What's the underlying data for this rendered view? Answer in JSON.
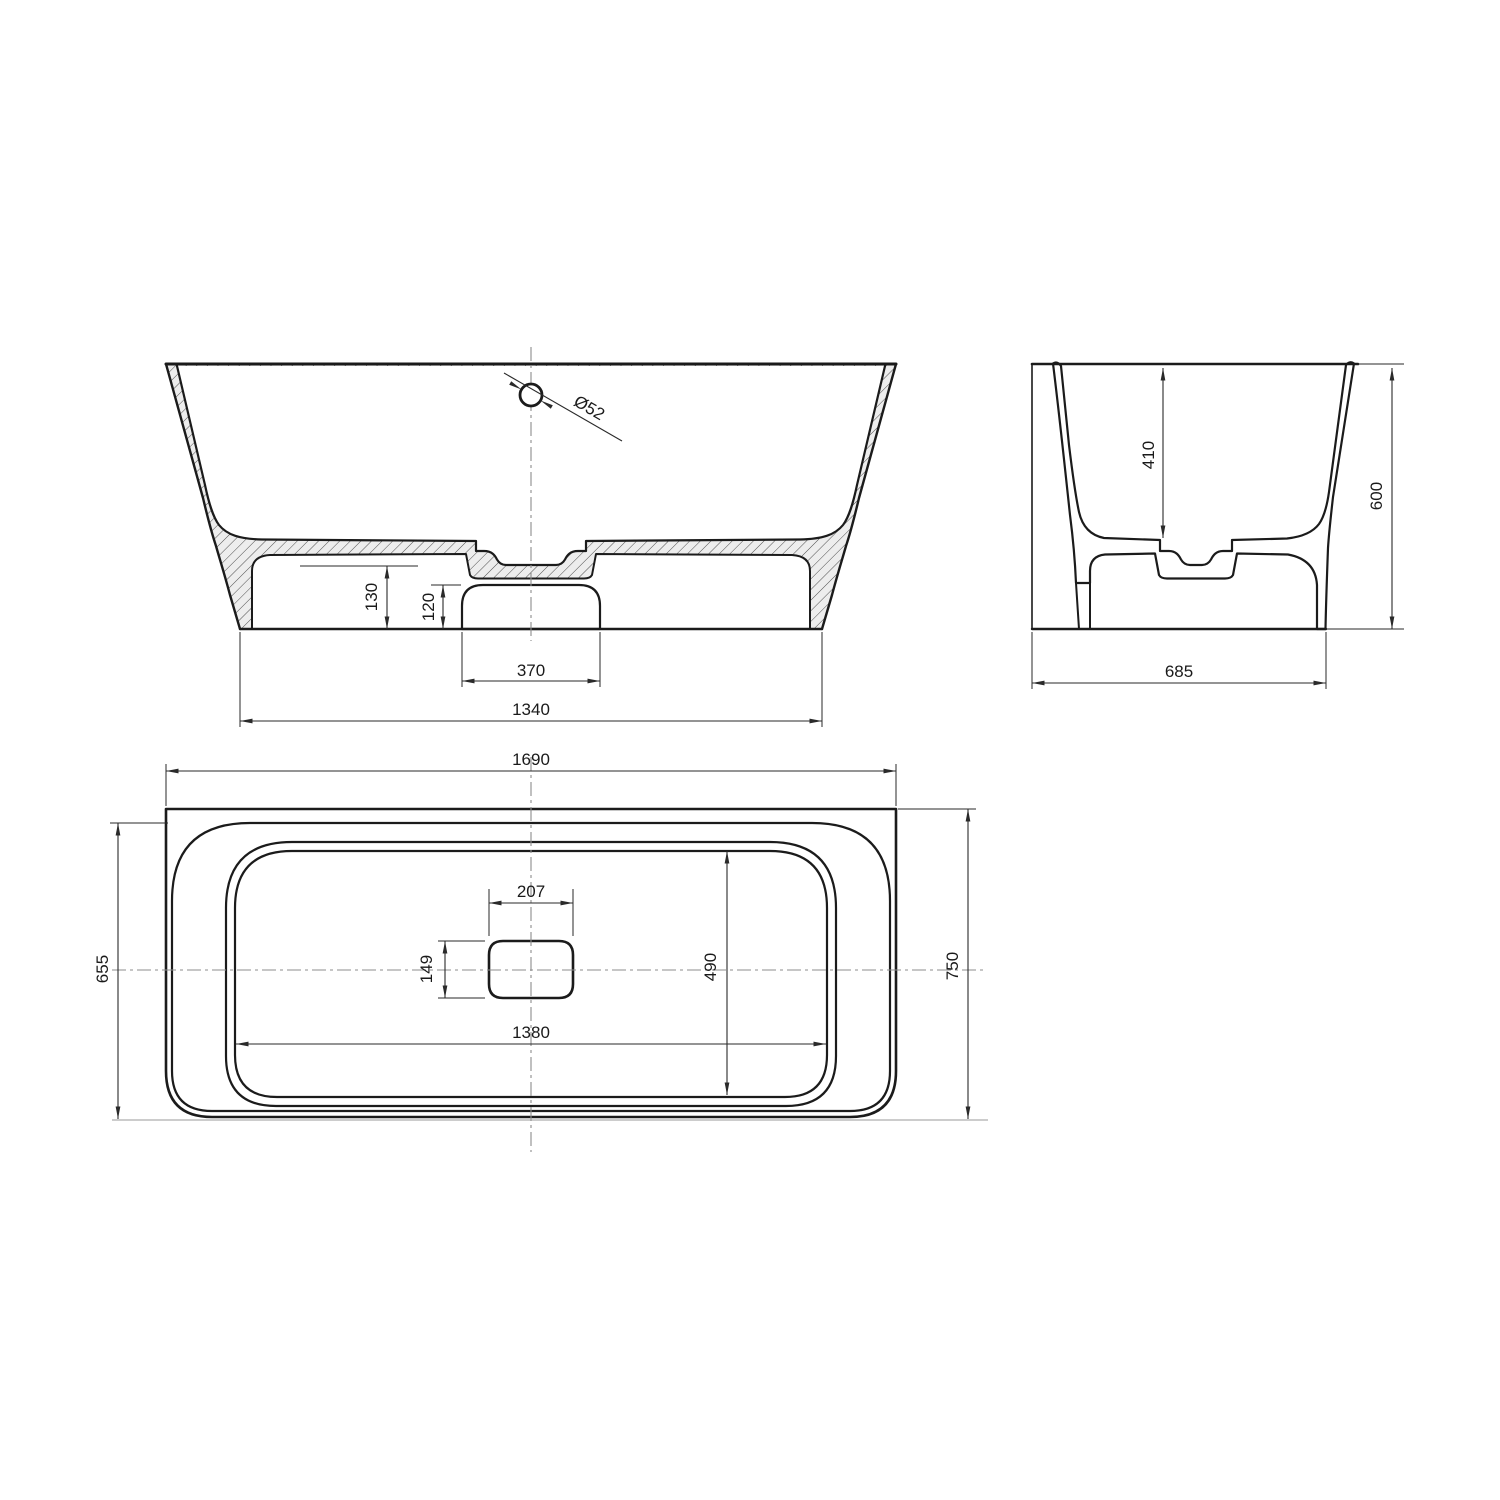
{
  "front": {
    "drain_diameter": "Ø52",
    "floor_height": "130",
    "plinth_recess_height": "120",
    "plinth_recess_width": "370",
    "base_width": "1340"
  },
  "side": {
    "interior_depth": "410",
    "overall_height": "600",
    "base_depth": "685"
  },
  "plan": {
    "overall_length": "1690",
    "back_width": "655",
    "overall_depth": "750",
    "drain_recess_length": "207",
    "drain_recess_width": "149",
    "floor_depth": "490",
    "floor_length": "1380"
  },
  "colors": {
    "line": "#1b1b1b",
    "dimension": "#2a2a2a",
    "plan_fill": "#e9e9e9",
    "hatch_fill": "#ededed",
    "hatch_stroke": "#3c3c3c",
    "centerline": "#8c8c8c",
    "background": "#ffffff"
  }
}
